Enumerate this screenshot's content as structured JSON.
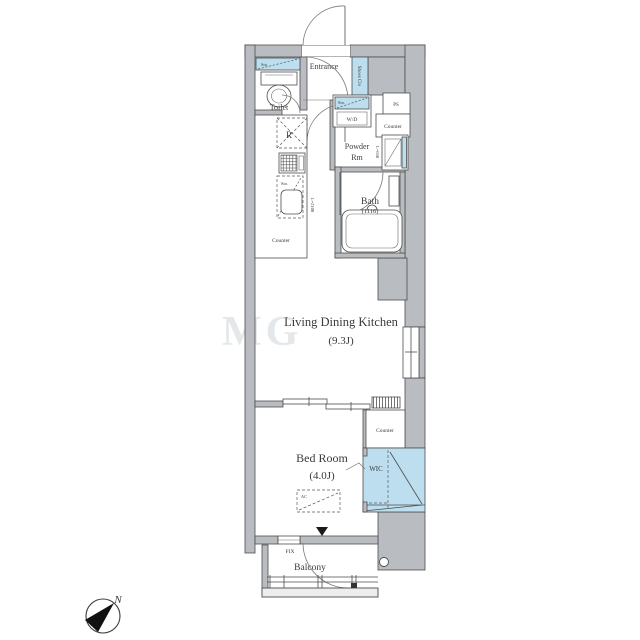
{
  "rooms": {
    "entrance": "Entrance",
    "toilet": "Toilet",
    "shoes_closet": "Shoes Clo",
    "washer_dryer": "W/D",
    "pipe_space": "PS",
    "counter_powder": "Counter",
    "powder_room_l1": "Powder",
    "powder_room_l2": "Rm",
    "bath": "Bath",
    "bath_size": "(1116)",
    "refrigerator": "R",
    "kitchen_counter": "Counter",
    "ldk": "Living Dining Kitchen",
    "ldk_size": "(9.3J)",
    "bedroom": "Bed Room",
    "bedroom_size": "(4.0J)",
    "wic": "WIC",
    "counter_bedroom": "Counter",
    "balcony": "Balcony"
  },
  "labels": {
    "storage_toilet": "Sto.",
    "storage_wd": "Sto.",
    "storage_kitchen": "Sto.",
    "ac_unit": "AC",
    "fix_window": "FIX",
    "kitchen_length": "L=2100",
    "basin_length": "L=650",
    "north": "N",
    "watermark": "MG"
  },
  "colors": {
    "wall_fill": "#b9bcc1",
    "fixture_blue": "#bcdeef",
    "line_dark": "#4d4d4d",
    "text": "#3b3b3b"
  }
}
